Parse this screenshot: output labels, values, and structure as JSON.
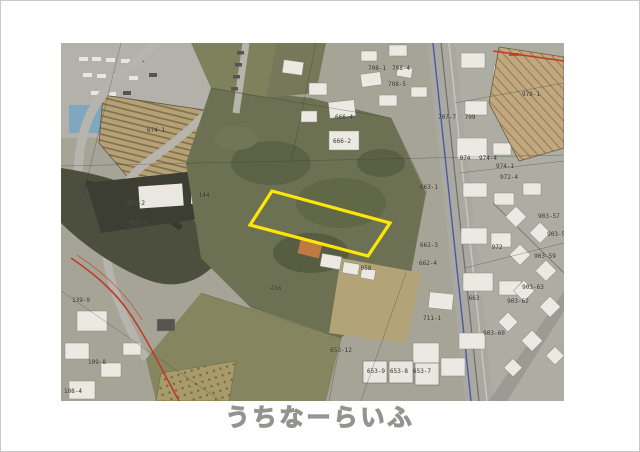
{
  "watermark": {
    "text": "うちなーらいふ"
  },
  "map": {
    "highlight_parcel": {
      "points": "211,148 329,180 307,213 189,182",
      "color": "#ffe608",
      "stroke_width": "3.2"
    },
    "label_color": "#2e2e2a",
    "accent_colors": {
      "rail_blue": "#4a5aa8",
      "boundary_red": "#c03a2c",
      "field_tan": "#c2a87e",
      "vegetation_green": "#6b7152",
      "road_gray": "#a9a8a1",
      "building_white": "#ebe9e2"
    },
    "labels": [
      {
        "text": "674-1",
        "x": 95,
        "y": 88
      },
      {
        "text": "645-2",
        "x": 75,
        "y": 161
      },
      {
        "text": "144",
        "x": 143,
        "y": 153
      },
      {
        "text": "545-3",
        "x": 78,
        "y": 181
      },
      {
        "text": "708-1",
        "x": 316,
        "y": 26
      },
      {
        "text": "708-4",
        "x": 340,
        "y": 26
      },
      {
        "text": "708-5",
        "x": 336,
        "y": 42
      },
      {
        "text": "666-4",
        "x": 283,
        "y": 75
      },
      {
        "text": "666-2",
        "x": 281,
        "y": 99
      },
      {
        "text": "707-7",
        "x": 386,
        "y": 75
      },
      {
        "text": "709",
        "x": 409,
        "y": 75
      },
      {
        "text": "978-1",
        "x": 470,
        "y": 52
      },
      {
        "text": "974",
        "x": 404,
        "y": 116
      },
      {
        "text": "974-4",
        "x": 427,
        "y": 116
      },
      {
        "text": "974-1",
        "x": 444,
        "y": 124
      },
      {
        "text": "972-4",
        "x": 448,
        "y": 135
      },
      {
        "text": "663-1",
        "x": 368,
        "y": 145
      },
      {
        "text": "662-3",
        "x": 368,
        "y": 203
      },
      {
        "text": "662-4",
        "x": 367,
        "y": 221
      },
      {
        "text": "972",
        "x": 436,
        "y": 205
      },
      {
        "text": "663",
        "x": 413,
        "y": 256
      },
      {
        "text": "711-1",
        "x": 371,
        "y": 276
      },
      {
        "text": "958",
        "x": 305,
        "y": 226
      },
      {
        "text": "436",
        "x": 215,
        "y": 246
      },
      {
        "text": "903-57",
        "x": 488,
        "y": 174
      },
      {
        "text": "903-58",
        "x": 497,
        "y": 192
      },
      {
        "text": "903-59",
        "x": 484,
        "y": 214
      },
      {
        "text": "903-62",
        "x": 457,
        "y": 259
      },
      {
        "text": "903-63",
        "x": 472,
        "y": 245
      },
      {
        "text": "903-60",
        "x": 433,
        "y": 291
      },
      {
        "text": "653-12",
        "x": 280,
        "y": 308
      },
      {
        "text": "653-9",
        "x": 315,
        "y": 329
      },
      {
        "text": "653-8",
        "x": 338,
        "y": 329
      },
      {
        "text": "653-7",
        "x": 361,
        "y": 329
      },
      {
        "text": "139-9",
        "x": 20,
        "y": 258
      },
      {
        "text": "109-8",
        "x": 36,
        "y": 320
      },
      {
        "text": "108-4",
        "x": 12,
        "y": 349
      }
    ]
  }
}
